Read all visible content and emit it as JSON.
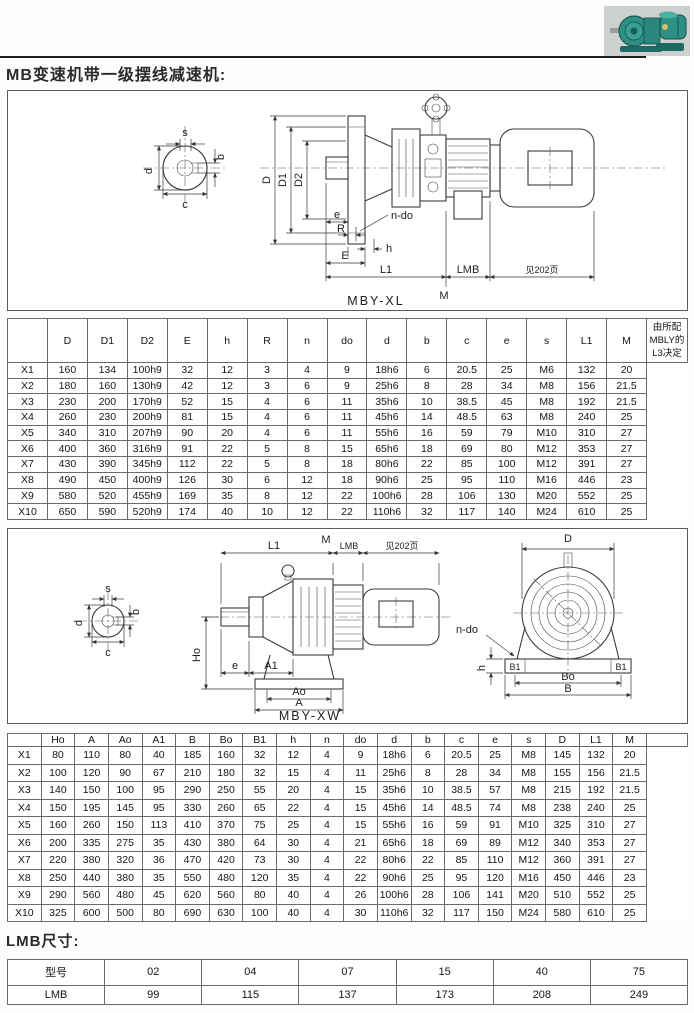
{
  "page": {
    "title": "MB变速机带一级摆线减速机:",
    "lmb_heading": "LMB尺寸:"
  },
  "diagram1": {
    "caption": "MBY-XL",
    "labels": {
      "s": "s",
      "b": "b",
      "d": "d",
      "c": "c",
      "D": "D",
      "D1": "D1",
      "D2": "D2",
      "n_do": "n-do",
      "e": "e",
      "R": "R",
      "h": "h",
      "E": "E",
      "L1": "L1",
      "LMB": "LMB",
      "see_page": "见202页",
      "M": "M"
    }
  },
  "diagram2": {
    "caption": "MBY-XW",
    "labels": {
      "s": "s",
      "b": "b",
      "d": "d",
      "c": "c",
      "L1": "L1",
      "M": "M",
      "LMB": "LMB",
      "see_page": "见202页",
      "Ho": "Ho",
      "e": "e",
      "A1": "A1",
      "Ao": "Ao",
      "A": "A",
      "D": "D",
      "n_do": "n-do",
      "h": "h",
      "B1": "B1",
      "Bo": "Bo",
      "B": "B"
    }
  },
  "table1": {
    "headers": [
      "",
      "D",
      "D1",
      "D2",
      "E",
      "h",
      "R",
      "n",
      "do",
      "d",
      "b",
      "c",
      "e",
      "s",
      "L1",
      "M"
    ],
    "note": "由所配MBLY的L3决定",
    "rows": [
      [
        "X1",
        "160",
        "134",
        "100h9",
        "32",
        "12",
        "3",
        "4",
        "9",
        "18h6",
        "6",
        "20.5",
        "25",
        "M6",
        "132",
        "20"
      ],
      [
        "X2",
        "180",
        "160",
        "130h9",
        "42",
        "12",
        "3",
        "6",
        "9",
        "25h6",
        "8",
        "28",
        "34",
        "M8",
        "156",
        "21.5"
      ],
      [
        "X3",
        "230",
        "200",
        "170h9",
        "52",
        "15",
        "4",
        "6",
        "11",
        "35h6",
        "10",
        "38.5",
        "45",
        "M8",
        "192",
        "21.5"
      ],
      [
        "X4",
        "260",
        "230",
        "200h9",
        "81",
        "15",
        "4",
        "6",
        "11",
        "45h6",
        "14",
        "48.5",
        "63",
        "M8",
        "240",
        "25"
      ],
      [
        "X5",
        "340",
        "310",
        "207h9",
        "90",
        "20",
        "4",
        "6",
        "11",
        "55h6",
        "16",
        "59",
        "79",
        "M10",
        "310",
        "27"
      ],
      [
        "X6",
        "400",
        "360",
        "316h9",
        "91",
        "22",
        "5",
        "8",
        "15",
        "65h6",
        "18",
        "69",
        "80",
        "M12",
        "353",
        "27"
      ],
      [
        "X7",
        "430",
        "390",
        "345h9",
        "112",
        "22",
        "5",
        "8",
        "18",
        "80h6",
        "22",
        "85",
        "100",
        "M12",
        "391",
        "27"
      ],
      [
        "X8",
        "490",
        "450",
        "400h9",
        "126",
        "30",
        "6",
        "12",
        "18",
        "90h6",
        "25",
        "95",
        "110",
        "M16",
        "446",
        "23"
      ],
      [
        "X9",
        "580",
        "520",
        "455h9",
        "169",
        "35",
        "8",
        "12",
        "22",
        "100h6",
        "28",
        "106",
        "130",
        "M20",
        "552",
        "25"
      ],
      [
        "X10",
        "650",
        "590",
        "520h9",
        "174",
        "40",
        "10",
        "12",
        "22",
        "110h6",
        "32",
        "117",
        "140",
        "M24",
        "610",
        "25"
      ]
    ]
  },
  "table2": {
    "headers": [
      "",
      "Ho",
      "A",
      "Ao",
      "A1",
      "B",
      "Bo",
      "B1",
      "h",
      "n",
      "do",
      "d",
      "b",
      "c",
      "e",
      "s",
      "D",
      "L1",
      "M"
    ],
    "note": "",
    "rows": [
      [
        "X1",
        "80",
        "110",
        "80",
        "40",
        "185",
        "160",
        "32",
        "12",
        "4",
        "9",
        "18h6",
        "6",
        "20.5",
        "25",
        "M8",
        "145",
        "132",
        "20"
      ],
      [
        "X2",
        "100",
        "120",
        "90",
        "67",
        "210",
        "180",
        "32",
        "15",
        "4",
        "11",
        "25h6",
        "8",
        "28",
        "34",
        "M8",
        "155",
        "156",
        "21.5"
      ],
      [
        "X3",
        "140",
        "150",
        "100",
        "95",
        "290",
        "250",
        "55",
        "20",
        "4",
        "15",
        "35h6",
        "10",
        "38.5",
        "57",
        "M8",
        "215",
        "192",
        "21.5"
      ],
      [
        "X4",
        "150",
        "195",
        "145",
        "95",
        "330",
        "260",
        "65",
        "22",
        "4",
        "15",
        "45h6",
        "14",
        "48.5",
        "74",
        "M8",
        "238",
        "240",
        "25"
      ],
      [
        "X5",
        "160",
        "260",
        "150",
        "113",
        "410",
        "370",
        "75",
        "25",
        "4",
        "15",
        "55h6",
        "16",
        "59",
        "91",
        "M10",
        "325",
        "310",
        "27"
      ],
      [
        "X6",
        "200",
        "335",
        "275",
        "35",
        "430",
        "380",
        "64",
        "30",
        "4",
        "21",
        "65h6",
        "18",
        "69",
        "89",
        "M12",
        "340",
        "353",
        "27"
      ],
      [
        "X7",
        "220",
        "380",
        "320",
        "36",
        "470",
        "420",
        "73",
        "30",
        "4",
        "22",
        "80h6",
        "22",
        "85",
        "110",
        "M12",
        "360",
        "391",
        "27"
      ],
      [
        "X8",
        "250",
        "440",
        "380",
        "35",
        "550",
        "480",
        "120",
        "35",
        "4",
        "22",
        "90h6",
        "25",
        "95",
        "120",
        "M16",
        "450",
        "446",
        "23"
      ],
      [
        "X9",
        "290",
        "560",
        "480",
        "45",
        "620",
        "560",
        "80",
        "40",
        "4",
        "26",
        "100h6",
        "28",
        "106",
        "141",
        "M20",
        "510",
        "552",
        "25"
      ],
      [
        "X10",
        "325",
        "600",
        "500",
        "80",
        "690",
        "630",
        "100",
        "40",
        "4",
        "30",
        "110h6",
        "32",
        "117",
        "150",
        "M24",
        "580",
        "610",
        "25"
      ]
    ]
  },
  "lmb_table": {
    "rows": [
      [
        "型号",
        "02",
        "04",
        "07",
        "15",
        "40",
        "75"
      ],
      [
        "LMB",
        "99",
        "115",
        "137",
        "173",
        "208",
        "249"
      ]
    ]
  }
}
